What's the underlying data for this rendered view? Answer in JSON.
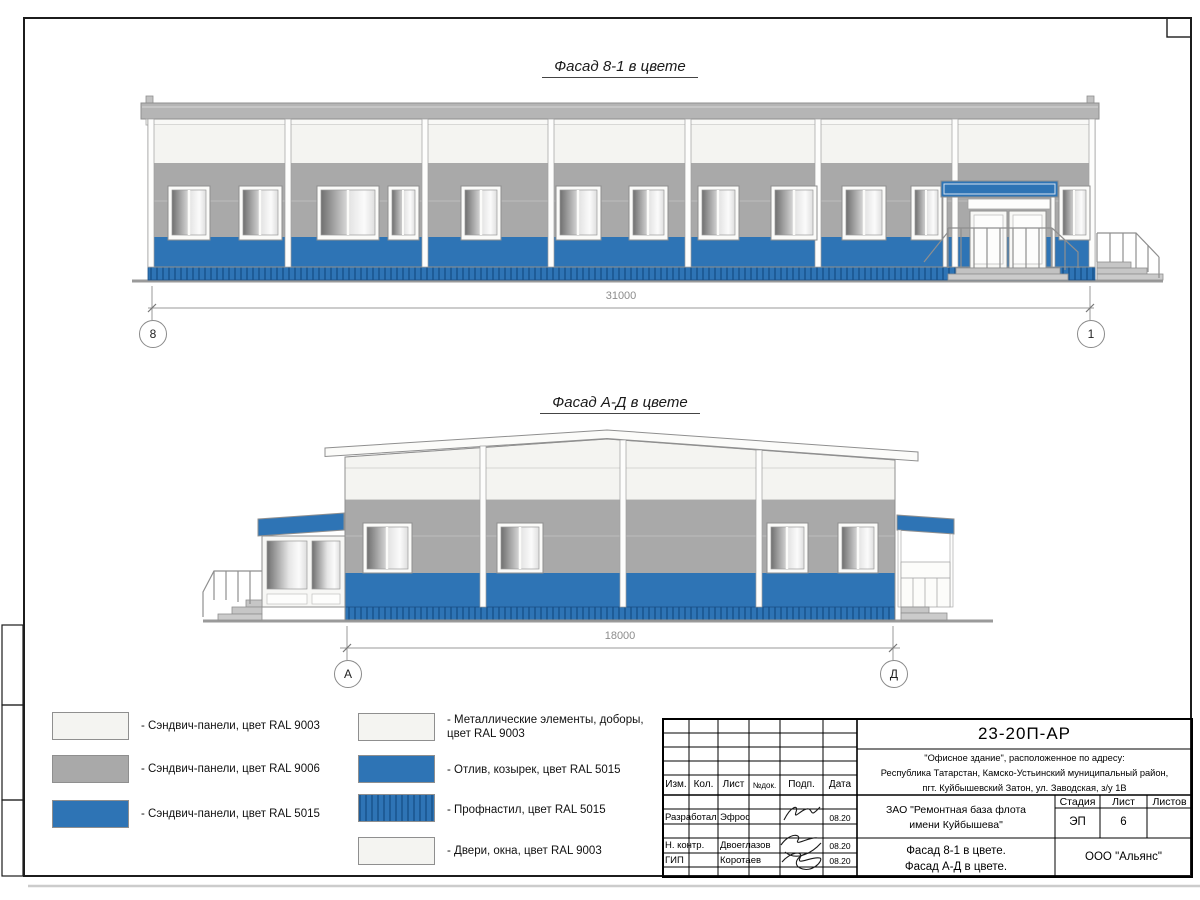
{
  "sheet": {
    "facade1": {
      "title": "Фасад 8-1 в цвете",
      "dimension": "31000",
      "axis_left": "8",
      "axis_right": "1"
    },
    "facade2": {
      "title": "Фасад А-Д в цвете",
      "dimension": "18000",
      "axis_left": "А",
      "axis_right": "Д"
    }
  },
  "legend": {
    "column1": [
      {
        "label": "- Сэндвич-панели, цвет RAL 9003",
        "swatch": "white-ral9003"
      },
      {
        "label": "- Сэндвич-панели, цвет RAL 9006",
        "swatch": "gray-ral9006"
      },
      {
        "label": "- Сэндвич-панели, цвет RAL 5015",
        "swatch": "blue-ral5015"
      }
    ],
    "column2": [
      {
        "label": "- Металлические элементы, доборы, цвет RAL 9003",
        "swatch": "white-ral9003"
      },
      {
        "label": "- Отлив, козырек, цвет RAL 5015",
        "swatch": "blue-ral5015"
      },
      {
        "label": "- Профнастил, цвет RAL 5015",
        "swatch": "corrugated-ral5015"
      },
      {
        "label": "- Двери, окна, цвет RAL 9003",
        "swatch": "white-ral9003"
      }
    ]
  },
  "title_block": {
    "doc_number": "23-20П-АР",
    "address": [
      "\"Офисное здание\", расположенное по адресу:",
      "Республика Татарстан, Камско-Устьинский муниципальный район,",
      "пгт. Куйбышевский Затон, ул. Заводская, з/у 1В"
    ],
    "columns": [
      "Изм.",
      "Кол.",
      "Лист",
      "№док.",
      "Подп.",
      "Дата"
    ],
    "signers": [
      {
        "role": "Разработал",
        "name": "Эфрос",
        "date": "08.20"
      },
      {
        "role": "Н. контр.",
        "name": "Двоеглазов",
        "date": "08.20"
      },
      {
        "role": "ГИП",
        "name": "Коротаев",
        "date": "08.20"
      }
    ],
    "client": [
      "ЗАО \"Ремонтная база флота",
      "имени Куйбышева\""
    ],
    "sheet_title": [
      "Фасад 8-1 в цвете.",
      "Фасад А-Д в цвете."
    ],
    "stage_header": [
      "Стадия",
      "Лист",
      "Листов"
    ],
    "stage": "ЭП",
    "sheet_number": "6",
    "sheets_total": "",
    "company": "ООО \"Альянс\""
  },
  "colors": {
    "blue_ral5015": "#2E74B5",
    "blue_dark_profile": "#1E5C97",
    "gray_ral9006": "#A9A9A9",
    "white_ral9003": "#F4F4F1",
    "roof_gray": "#B5B5B5"
  }
}
